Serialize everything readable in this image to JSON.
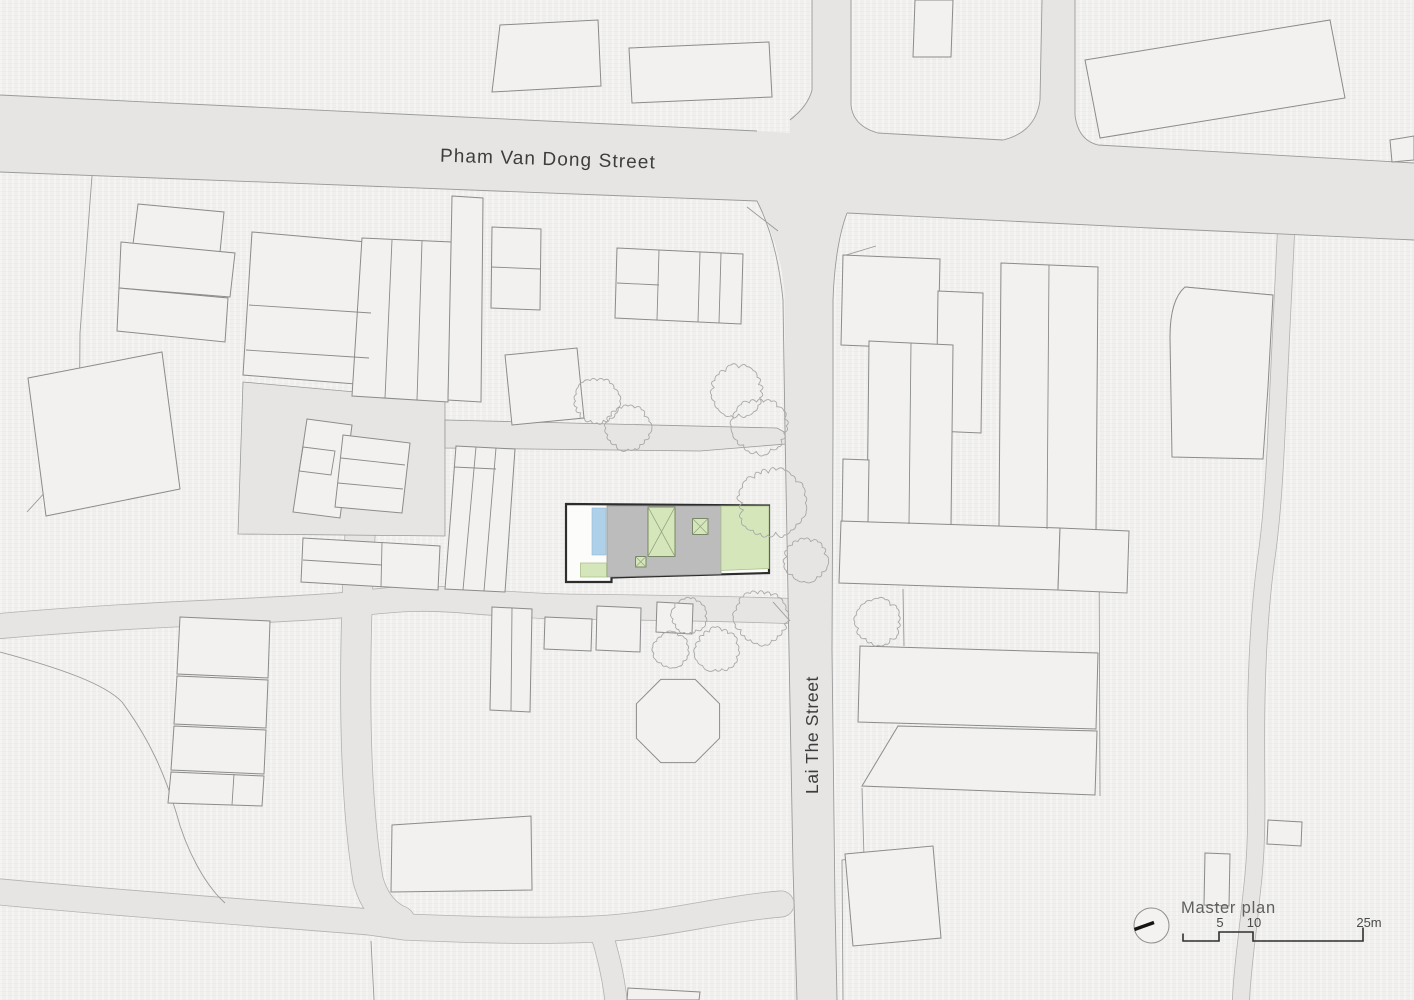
{
  "document": {
    "kind": "architectural master plan drawing",
    "title": "Master plan"
  },
  "labels": {
    "street_horizontal": "Pham Van Dong Street",
    "street_vertical": "Lai The Street",
    "legend_title": "Master plan"
  },
  "scale_bar": {
    "tick_labels": [
      "5",
      "10",
      "25m"
    ],
    "unit": "m"
  },
  "colors": {
    "background": "#f0efed",
    "street": "#e6e5e3",
    "building_outline": "#8b8b8b",
    "site_outline": "#2d2d2d",
    "roof_gray": "#bcbcbc",
    "landscape_green": "#d5e7ba",
    "pool_blue": "#aed0e8",
    "plot_white": "#fcfcfb",
    "tree_stroke": "#a8a8a8"
  }
}
